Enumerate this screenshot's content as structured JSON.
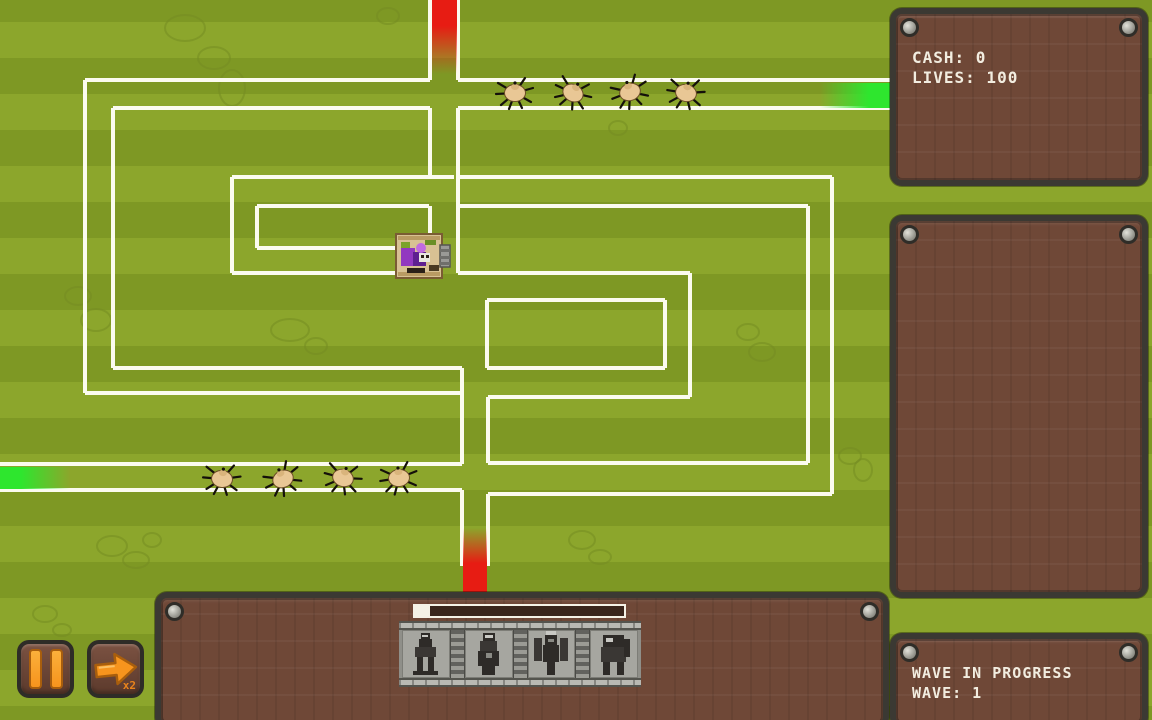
{
  "hud": {
    "cash": "CASH: 0",
    "lives": "LIVES: 100"
  },
  "wave_panel": {
    "status": "WAVE IN PROGRESS",
    "wave": "WAVE: 1"
  },
  "controls": {
    "fast_forward_multiplier": "x2"
  },
  "build_bar": {
    "progress_percent": 7,
    "towers": [
      {
        "icon": "rider-tower-icon"
      },
      {
        "icon": "monk-tower-icon"
      },
      {
        "icon": "winged-demon-tower-icon"
      },
      {
        "icon": "elephant-tower-icon"
      }
    ]
  },
  "colors": {
    "grass_light": "#8CA62C",
    "grass_dark": "#7E9824",
    "path": "#FBFBEF",
    "panel_fill": "#6F4837",
    "panel_border": "#3B3933",
    "text": "#F2EDE0",
    "accent_orange": "#F7941D",
    "spawn_red": "#E71C13",
    "spawn_green": "#2EE62E"
  },
  "map": {
    "path_segments": [
      [
        85,
        80,
        430,
        80
      ],
      [
        458,
        80,
        890,
        80
      ],
      [
        113,
        108,
        430,
        108
      ],
      [
        458,
        108,
        890,
        108
      ],
      [
        232,
        177,
        454,
        177
      ],
      [
        459,
        177,
        832,
        177
      ],
      [
        257,
        206,
        429,
        206
      ],
      [
        459,
        206,
        808,
        206
      ],
      [
        257,
        248,
        396,
        248
      ],
      [
        232,
        273,
        395,
        273
      ],
      [
        458,
        273,
        690,
        273
      ],
      [
        487,
        300,
        665,
        300
      ],
      [
        113,
        368,
        462,
        368
      ],
      [
        487,
        368,
        665,
        368
      ],
      [
        85,
        393,
        462,
        393
      ],
      [
        488,
        397,
        690,
        397
      ],
      [
        0,
        464,
        462,
        464
      ],
      [
        488,
        463,
        808,
        463
      ],
      [
        0,
        490,
        462,
        490
      ],
      [
        488,
        494,
        832,
        494
      ],
      [
        430,
        0,
        430,
        80
      ],
      [
        458,
        0,
        458,
        80
      ],
      [
        430,
        108,
        430,
        177
      ],
      [
        430,
        206,
        430,
        237
      ],
      [
        458,
        108,
        458,
        273
      ],
      [
        85,
        80,
        85,
        393
      ],
      [
        113,
        108,
        113,
        368
      ],
      [
        232,
        177,
        232,
        273
      ],
      [
        257,
        206,
        257,
        248
      ],
      [
        832,
        177,
        832,
        494
      ],
      [
        808,
        206,
        808,
        463
      ],
      [
        690,
        273,
        690,
        397
      ],
      [
        665,
        300,
        665,
        368
      ],
      [
        487,
        300,
        487,
        368
      ],
      [
        462,
        368,
        462,
        464
      ],
      [
        462,
        490,
        462,
        566
      ],
      [
        488,
        397,
        488,
        463
      ],
      [
        488,
        494,
        488,
        566
      ]
    ],
    "spawn_points": [
      {
        "name": "top-red-portal",
        "color": "#E71C13",
        "x": 432,
        "y": 0,
        "w": 25,
        "h": 74,
        "fade": "down"
      },
      {
        "name": "bottom-red-portal",
        "color": "#E71C13",
        "x": 463,
        "y": 528,
        "w": 24,
        "h": 64,
        "fade": "up"
      },
      {
        "name": "left-green-portal",
        "color": "#2EE62E",
        "x": 0,
        "y": 467,
        "w": 70,
        "h": 22,
        "fade": "right"
      },
      {
        "name": "right-green-portal",
        "color": "#2EE62E",
        "x": 820,
        "y": 83,
        "w": 70,
        "h": 25,
        "fade": "left"
      }
    ],
    "enemies": [
      {
        "x": 515,
        "y": 93,
        "rot": 0
      },
      {
        "x": 573,
        "y": 93,
        "rot": 28
      },
      {
        "x": 630,
        "y": 92,
        "rot": -18
      },
      {
        "x": 686,
        "y": 93,
        "rot": 12
      },
      {
        "x": 222,
        "y": 479,
        "rot": 8
      },
      {
        "x": 283,
        "y": 479,
        "rot": -24
      },
      {
        "x": 343,
        "y": 478,
        "rot": 18
      },
      {
        "x": 399,
        "y": 478,
        "rot": -6
      }
    ],
    "boss": {
      "x": 395,
      "y": 232
    },
    "decorations": [
      [
        185,
        28,
        20,
        13
      ],
      [
        214,
        58,
        16,
        11
      ],
      [
        232,
        88,
        13,
        18
      ],
      [
        78,
        296,
        13,
        9
      ],
      [
        96,
        320,
        15,
        11
      ],
      [
        290,
        330,
        19,
        11
      ],
      [
        316,
        346,
        11,
        8
      ],
      [
        748,
        332,
        11,
        8
      ],
      [
        762,
        352,
        13,
        9
      ],
      [
        850,
        456,
        11,
        8
      ],
      [
        863,
        470,
        9,
        11
      ],
      [
        112,
        546,
        15,
        10
      ],
      [
        136,
        560,
        13,
        8
      ],
      [
        152,
        540,
        9,
        7
      ],
      [
        582,
        540,
        13,
        9
      ],
      [
        600,
        557,
        11,
        7
      ],
      [
        388,
        16,
        11,
        8
      ],
      [
        618,
        128,
        9,
        7
      ],
      [
        45,
        614,
        12,
        8
      ],
      [
        62,
        630,
        9,
        6
      ]
    ]
  }
}
